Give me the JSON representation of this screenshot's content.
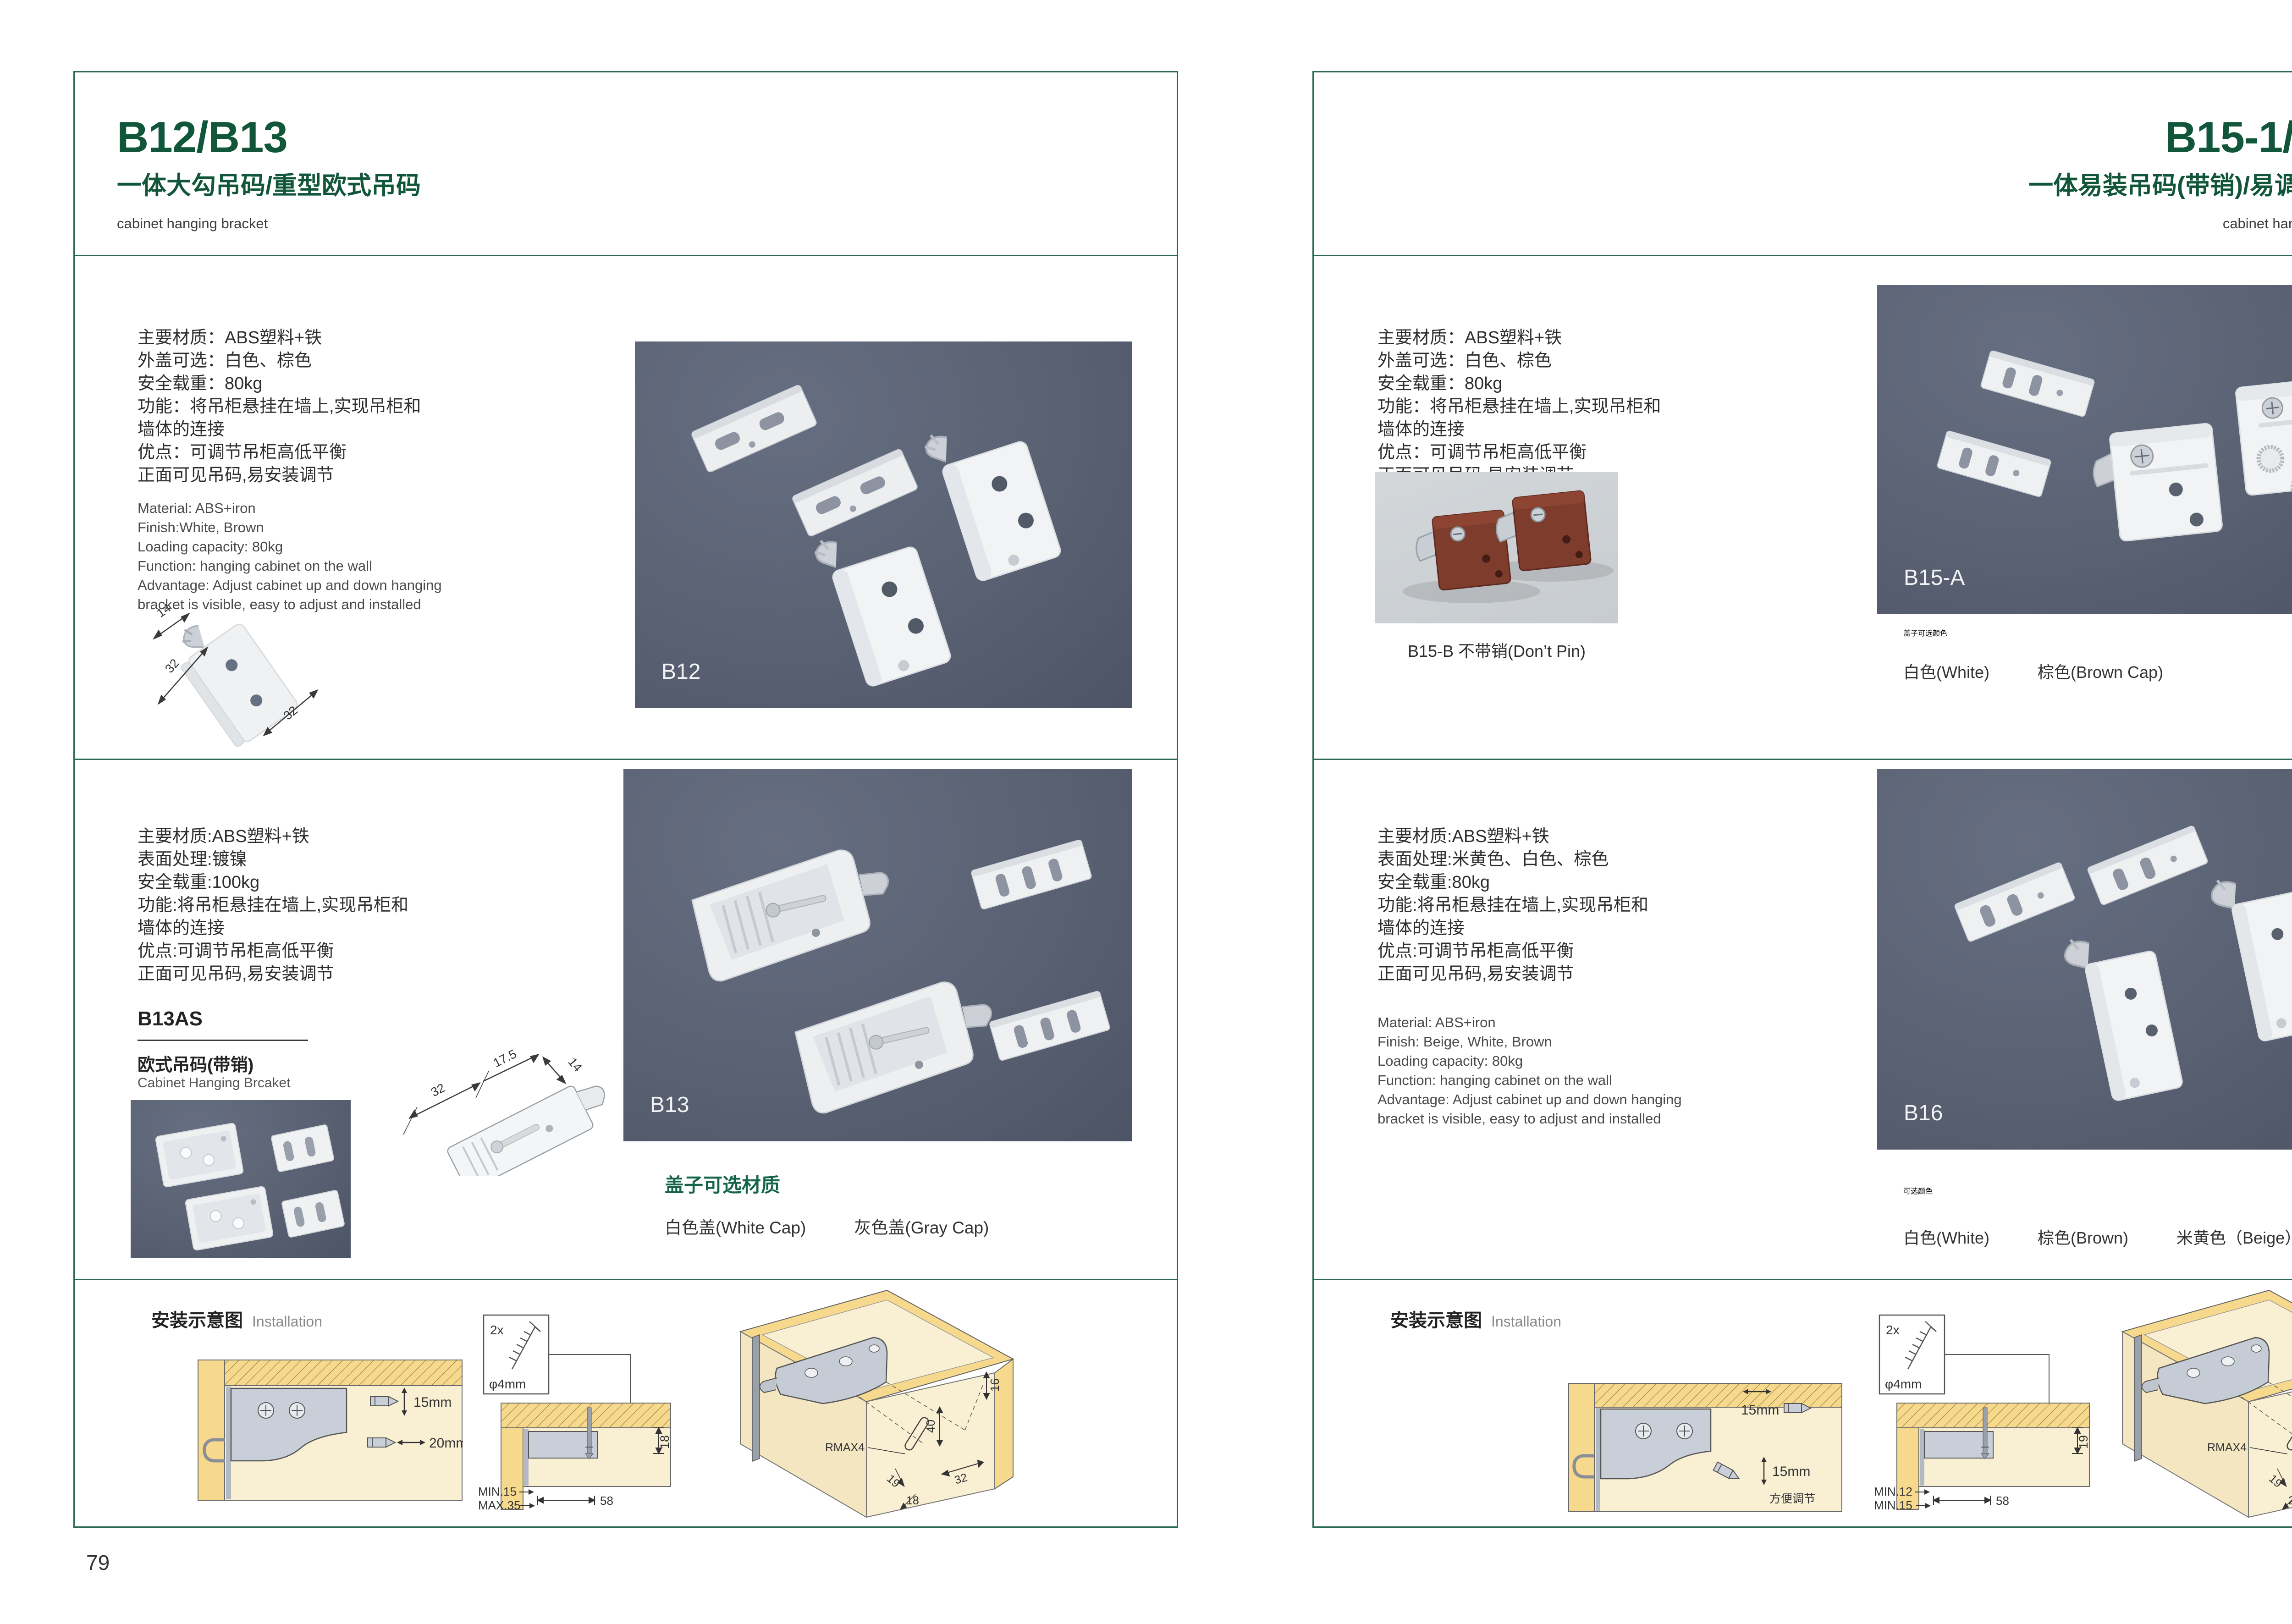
{
  "colors": {
    "accent_green": "#11563b",
    "border_green": "#2a6a52",
    "photo_bg_dark": "#596173",
    "photo_bg_light": "#ccd1d5",
    "wood_yellow": "#f6d98c",
    "wood_beige": "#f9efd3",
    "plastic_brown": "#7e3c2c"
  },
  "left": {
    "page_number": "79",
    "header": {
      "title": "B12/B13",
      "subtitle": "一体大勾吊码/重型欧式吊码",
      "tagline": "cabinet hanging bracket"
    },
    "b12": {
      "specs_cn": [
        "主要材质：ABS塑料+铁",
        "外盖可选：白色、棕色",
        "安全载重：80kg",
        "功能：将吊柜悬挂在墙上,实现吊柜和",
        "墙体的连接",
        "优点：可调节吊柜高低平衡",
        "正面可见吊码,易安装调节"
      ],
      "specs_en": [
        "Material: ABS+iron",
        "Finish:White, Brown",
        "Loading capacity: 80kg",
        "Function: hanging cabinet on the wall",
        "Advantage: Adjust cabinet up and down hanging",
        "bracket is visible, easy to adjust and installed"
      ],
      "dim_labels": [
        "14",
        "32",
        "32"
      ],
      "photo_label": "B12"
    },
    "b13": {
      "specs_cn": [
        "主要材质:ABS塑料+铁",
        "表面处理:镀镍",
        "安全载重:100kg",
        "功能:将吊柜悬挂在墙上,实现吊柜和",
        "墙体的连接",
        "优点:可调节吊柜高低平衡",
        "正面可见吊码,易安装调节"
      ],
      "code": "B13AS",
      "name_cn": "欧式吊码(带销)",
      "name_en": "Cabinet Hanging Brcaket",
      "diagram_dims": [
        "32",
        "17.5",
        "14"
      ],
      "photo_label": "B13",
      "options_title": "盖子可选材质",
      "options": [
        "白色盖(White Cap)",
        "灰色盖(Gray Cap)"
      ]
    },
    "installation": {
      "title_cn": "安装示意图",
      "title_en": "Installation",
      "d1_dim_top": "15mm",
      "d1_dim_bottom": "20mm",
      "d2_screw_count": "2x",
      "d2_screw_dia": "φ4mm",
      "d2_dim_side": "18",
      "d2_dim_a": "MIN.15",
      "d2_dim_b": "MAX.35",
      "d2_dim_c": "58",
      "d3_dims": [
        "16",
        "40",
        "RMAX4",
        "19",
        "18",
        "32"
      ]
    }
  },
  "right": {
    "page_number": "80",
    "header": {
      "title": "B15-1/B16",
      "subtitle": "一体易装吊码(带销)/易调节吊码",
      "tagline": "cabinet hanging bracket"
    },
    "b15": {
      "specs_cn": [
        "主要材质：ABS塑料+铁",
        "外盖可选：白色、棕色",
        "安全载重：80kg",
        "功能：将吊柜悬挂在墙上,实现吊柜和",
        "墙体的连接",
        "优点：可调节吊柜高低平衡",
        "正面可见吊码,易安装调节"
      ],
      "sub_photo_caption": "B15-B 不带销(Don’t Pin)",
      "photo_label": "B15-A",
      "options_title": "盖子可选颜色",
      "options": [
        "白色(White)",
        "棕色(Brown Cap)"
      ]
    },
    "b16": {
      "specs_cn": [
        "主要材质:ABS塑料+铁",
        "表面处理:米黄色、白色、棕色",
        "安全载重:80kg",
        "功能:将吊柜悬挂在墙上,实现吊柜和",
        "墙体的连接",
        "优点:可调节吊柜高低平衡",
        "正面可见吊码,易安装调节"
      ],
      "specs_en": [
        "Material: ABS+iron",
        "Finish: Beige, White, Brown",
        "Loading capacity: 80kg",
        "Function: hanging cabinet on the wall",
        "Advantage: Adjust cabinet up and down hanging",
        "bracket is visible, easy to adjust and installed"
      ],
      "photo_label": "B16",
      "options_title": "可选颜色",
      "options": [
        "白色(White)",
        "棕色(Brown)",
        "米黄色（Beige）"
      ]
    },
    "installation": {
      "title_cn": "安装示意图",
      "title_en": "Installation",
      "d1_dim_top": "15mm",
      "d1_dim_bottom": "15mm",
      "d1_note": "方便调节",
      "d2_screw_count": "2x",
      "d2_screw_dia": "φ4mm",
      "d2_dim_side": "19",
      "d2_dim_a": "MIN.12",
      "d2_dim_b": "MIN.15",
      "d2_dim_c": "58",
      "d3_dims": [
        "30",
        "32",
        "RMAX4",
        "19",
        "20",
        "32"
      ]
    }
  }
}
